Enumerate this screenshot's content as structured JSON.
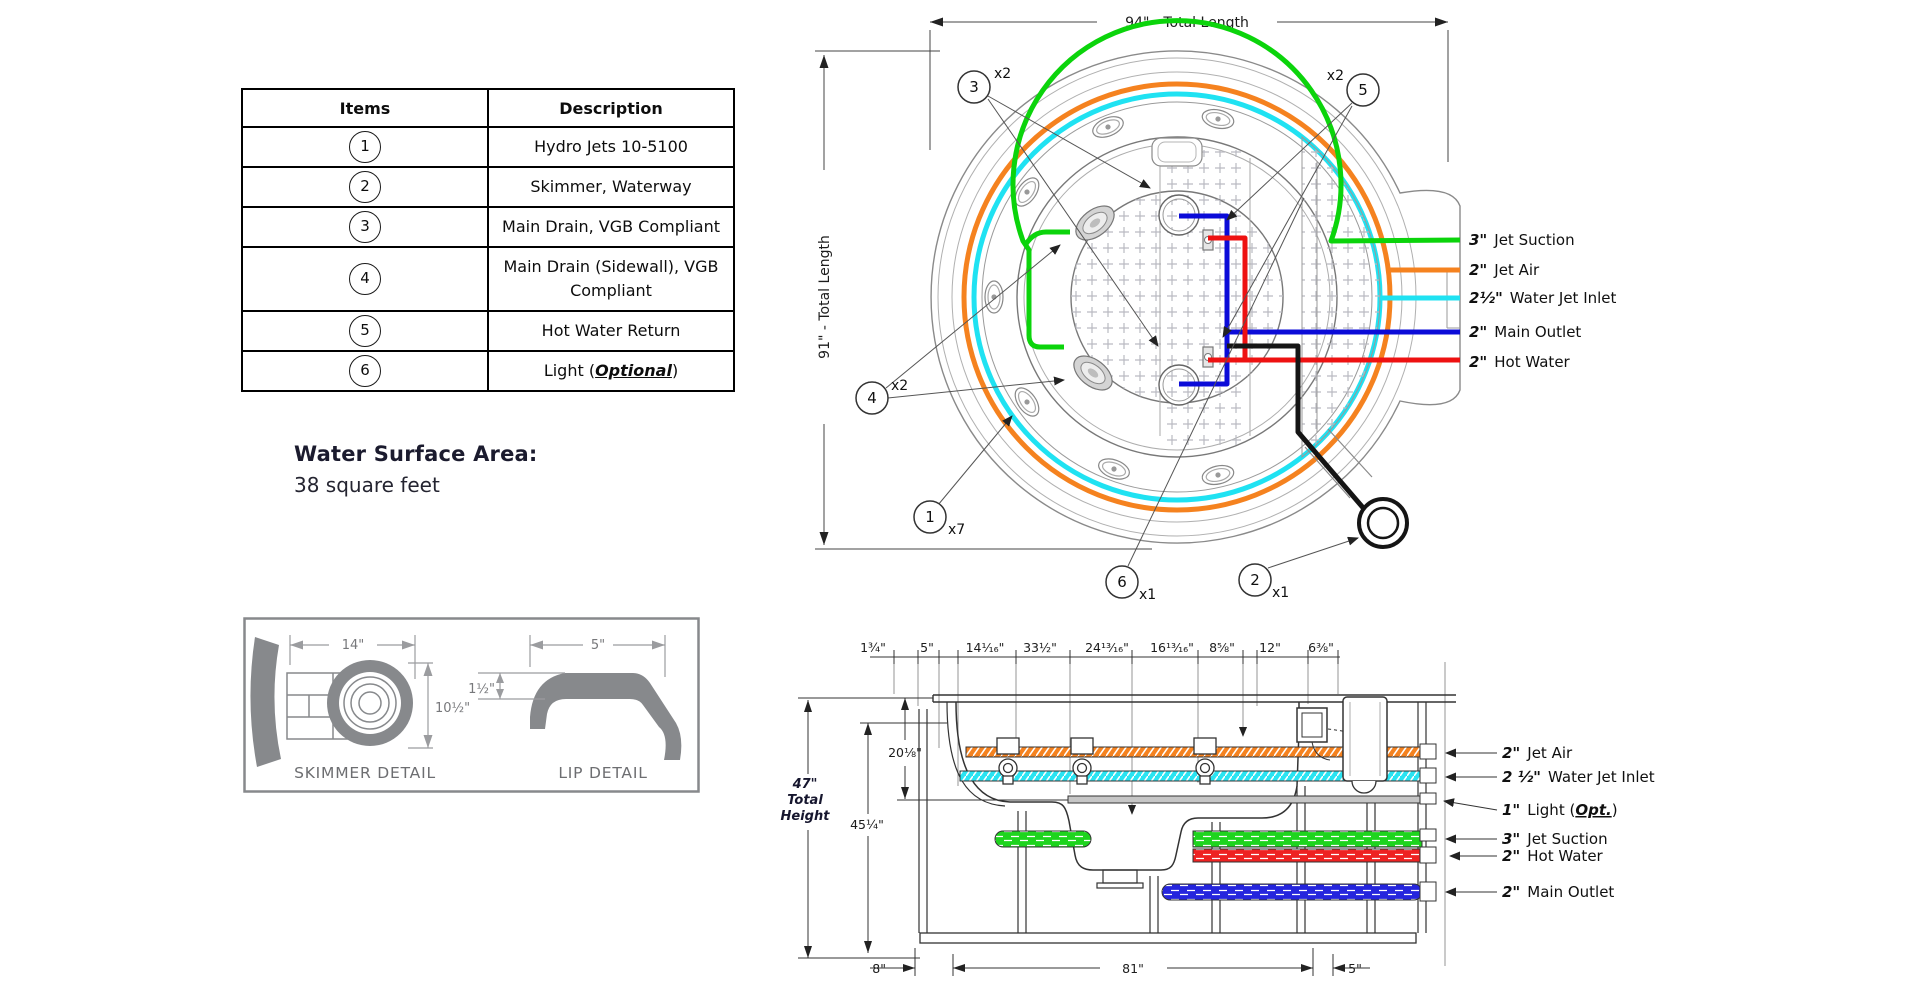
{
  "parts_table": {
    "headers": [
      "Items",
      "Description"
    ],
    "rows": [
      {
        "num": "1",
        "desc": "Hydro Jets 10-5100",
        "em": "",
        "end": ""
      },
      {
        "num": "2",
        "desc": "Skimmer, Waterway",
        "em": "",
        "end": ""
      },
      {
        "num": "3",
        "desc": "Main Drain, VGB Compliant",
        "em": "",
        "end": ""
      },
      {
        "num": "4",
        "desc": "Main Drain (Sidewall), VGB Compliant",
        "em": "",
        "end": ""
      },
      {
        "num": "5",
        "desc": "Hot Water Return",
        "em": "",
        "end": ""
      },
      {
        "num": "6",
        "desc": "Light (",
        "em": "Optional",
        "end": ")"
      }
    ]
  },
  "water_surface_area": {
    "label": "Water Surface Area:",
    "value": "38 square feet"
  },
  "top_view": {
    "dim_top": "94\" - Total Length",
    "dim_left": "91\" - Total Length",
    "balloons": {
      "b3": {
        "num": "3",
        "qty": "x2"
      },
      "b5": {
        "num": "5",
        "qty": "x2"
      },
      "b4": {
        "num": "4",
        "qty": "x2"
      },
      "b1": {
        "num": "1",
        "qty": "x7"
      },
      "b6": {
        "num": "6",
        "qty": "x1"
      },
      "b2": {
        "num": "2",
        "qty": "x1"
      }
    },
    "legend": [
      {
        "size": "3\"",
        "name": "Jet Suction",
        "color": "#0bd40b"
      },
      {
        "size": "2\"",
        "name": "Jet Air",
        "color": "#f5821f"
      },
      {
        "size": "2½\"",
        "name": "Water Jet Inlet",
        "color": "#1fe2f2"
      },
      {
        "size": "2\"",
        "name": "Main Outlet",
        "color": "#0b0bd8"
      },
      {
        "size": "2\"",
        "name": "Hot Water",
        "color": "#ee1111"
      }
    ]
  },
  "details": {
    "skimmer": {
      "dim_w": "14\"",
      "dim_h": "10½\"",
      "label": "SKIMMER DETAIL"
    },
    "lip": {
      "dim_w": "5\"",
      "dim_h": "1½\"",
      "label": "LIP DETAIL"
    }
  },
  "side_view": {
    "dims_top": [
      "1¾\"",
      "5\"",
      "14¹⁄₁₆\"",
      "33½\"",
      "24¹³⁄₁₆\"",
      "16¹³⁄₁₆\"",
      "8⅝\"",
      "12\"",
      "6⅜\""
    ],
    "dim_total_height": {
      "l1": "47\"",
      "l2": "Total",
      "l3": "Height"
    },
    "dim_45": "45¼\"",
    "dim_20": "20⅛\"",
    "dims_bottom": [
      "8\"",
      "81\"",
      "5\""
    ],
    "legend": [
      {
        "size": "2\"",
        "name": "Jet Air",
        "em": "",
        "end": ""
      },
      {
        "size": "2 ½\"",
        "name": "Water Jet Inlet",
        "em": "",
        "end": ""
      },
      {
        "size": "1\"",
        "name": "Light (",
        "em": "Opt.",
        "end": ")"
      },
      {
        "size": "3\"",
        "name": "Jet Suction",
        "em": "",
        "end": ""
      },
      {
        "size": "2\"",
        "name": "Hot Water",
        "em": "",
        "end": ""
      },
      {
        "size": "2\"",
        "name": "Main Outlet",
        "em": "",
        "end": ""
      }
    ]
  }
}
